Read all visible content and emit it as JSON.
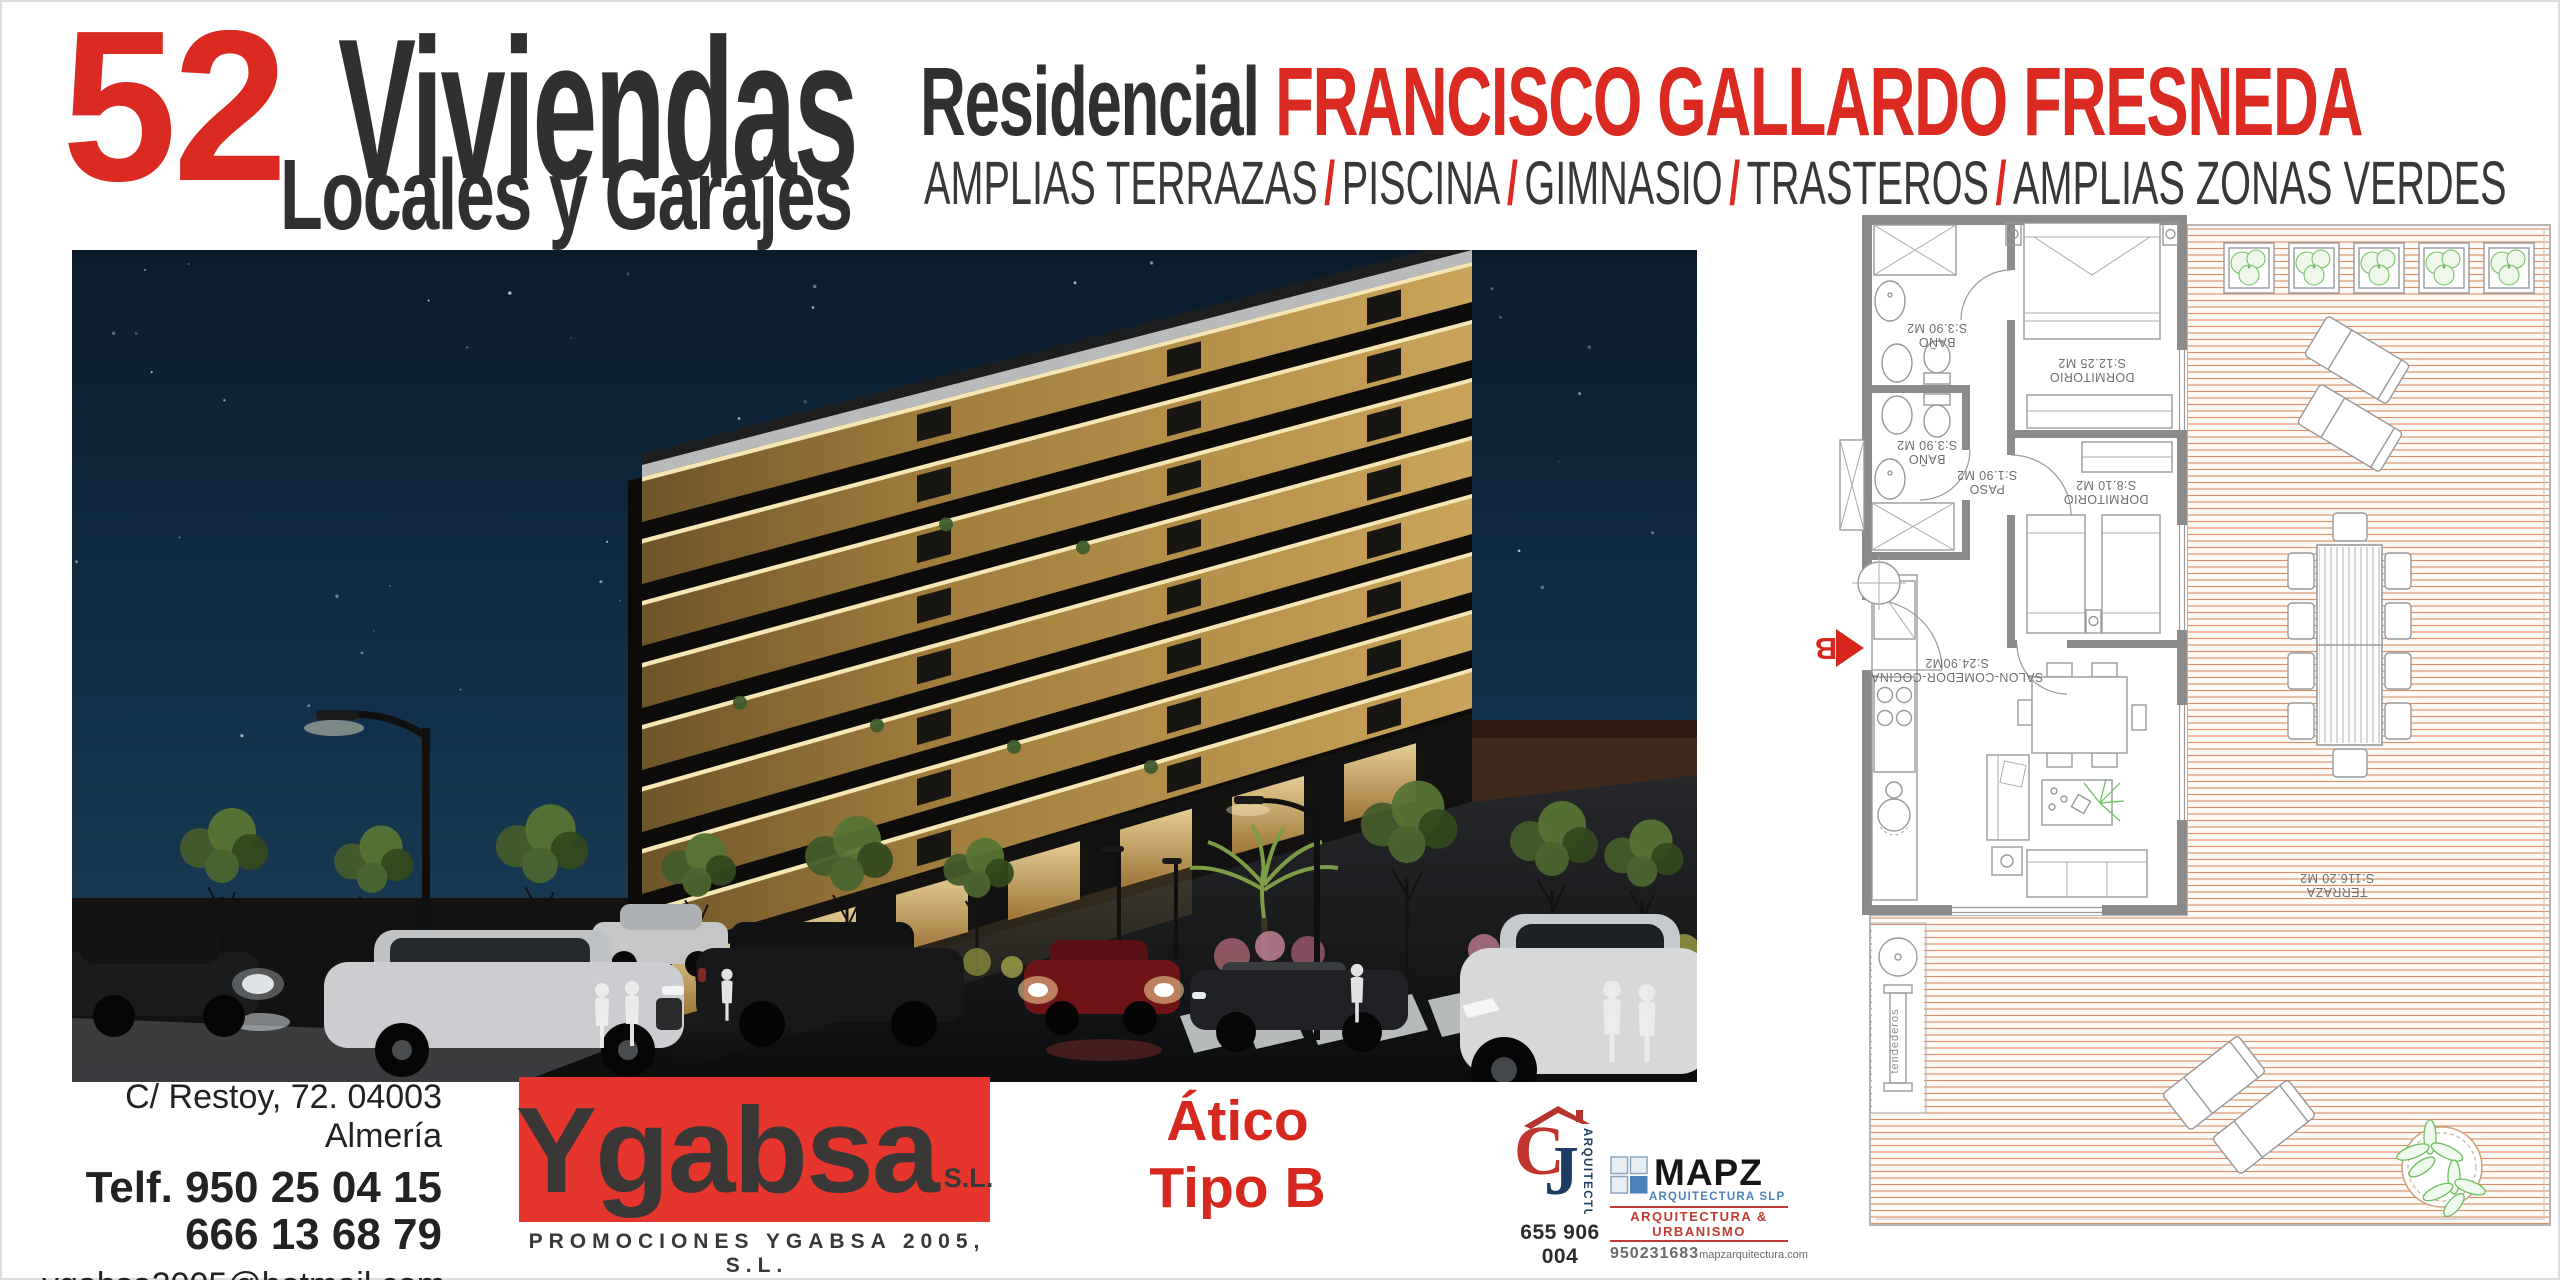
{
  "header": {
    "count": "52",
    "units": "Viviendas",
    "sub": "Locales y Garajes",
    "res_prefix": "Residencial ",
    "res_name": "FRANCISCO GALLARDO FRESNEDA",
    "amenities": [
      "AMPLIAS TERRAZAS",
      "PISCINA",
      "GIMNASIO",
      "TRASTEROS",
      "AMPLIAS ZONAS VERDES"
    ],
    "sep": "/"
  },
  "contact": {
    "address": "C/ Restoy, 72. 04003 Almería",
    "phone1": "Telf. 950 25 04 15",
    "phone2": "666 13 68 79",
    "email": "ygabsa2005@hotmail.com"
  },
  "developer": {
    "name": "Ygabsa",
    "suffix": "S.L.",
    "tagline": "PROMOCIONES YGABSA 2005, S.L."
  },
  "unit": {
    "line1": "Ático",
    "line2": "Tipo B"
  },
  "architects": {
    "cj": {
      "vertical": "ARQUITECTURA",
      "phone": "655 906 004"
    },
    "mapz": {
      "name": "MAPZ",
      "sub": "ARQUITECTURA SLP",
      "band": "ARQUITECTURA & URBANISMO",
      "phone": "950231683",
      "web": "mapzarquitectura.com"
    }
  },
  "floorplan": {
    "entrance": "B",
    "bano1": {
      "name": "BAÑO",
      "area": "S:3.90 M2"
    },
    "bano2": {
      "name": "BAÑO",
      "area": "S:3.90 M2"
    },
    "dorm1": {
      "name": "DORMITORIO",
      "area": "S:12.25 M2"
    },
    "paso": {
      "name": "PASO",
      "area": "S:1.90 M2"
    },
    "dorm2": {
      "name": "DORMITORIO",
      "area": "S:8.10 M2"
    },
    "salon": {
      "name": "SALON-COMEDOR-COCINA",
      "area": "S:24.90M2"
    },
    "terraza": {
      "name": "TERRAZA",
      "area": "S:116.20 M2"
    },
    "tendederos": "tendederos"
  },
  "colors": {
    "accent_red": "#da2a21",
    "box_red": "#e5352c",
    "dark_text": "#322f30"
  }
}
